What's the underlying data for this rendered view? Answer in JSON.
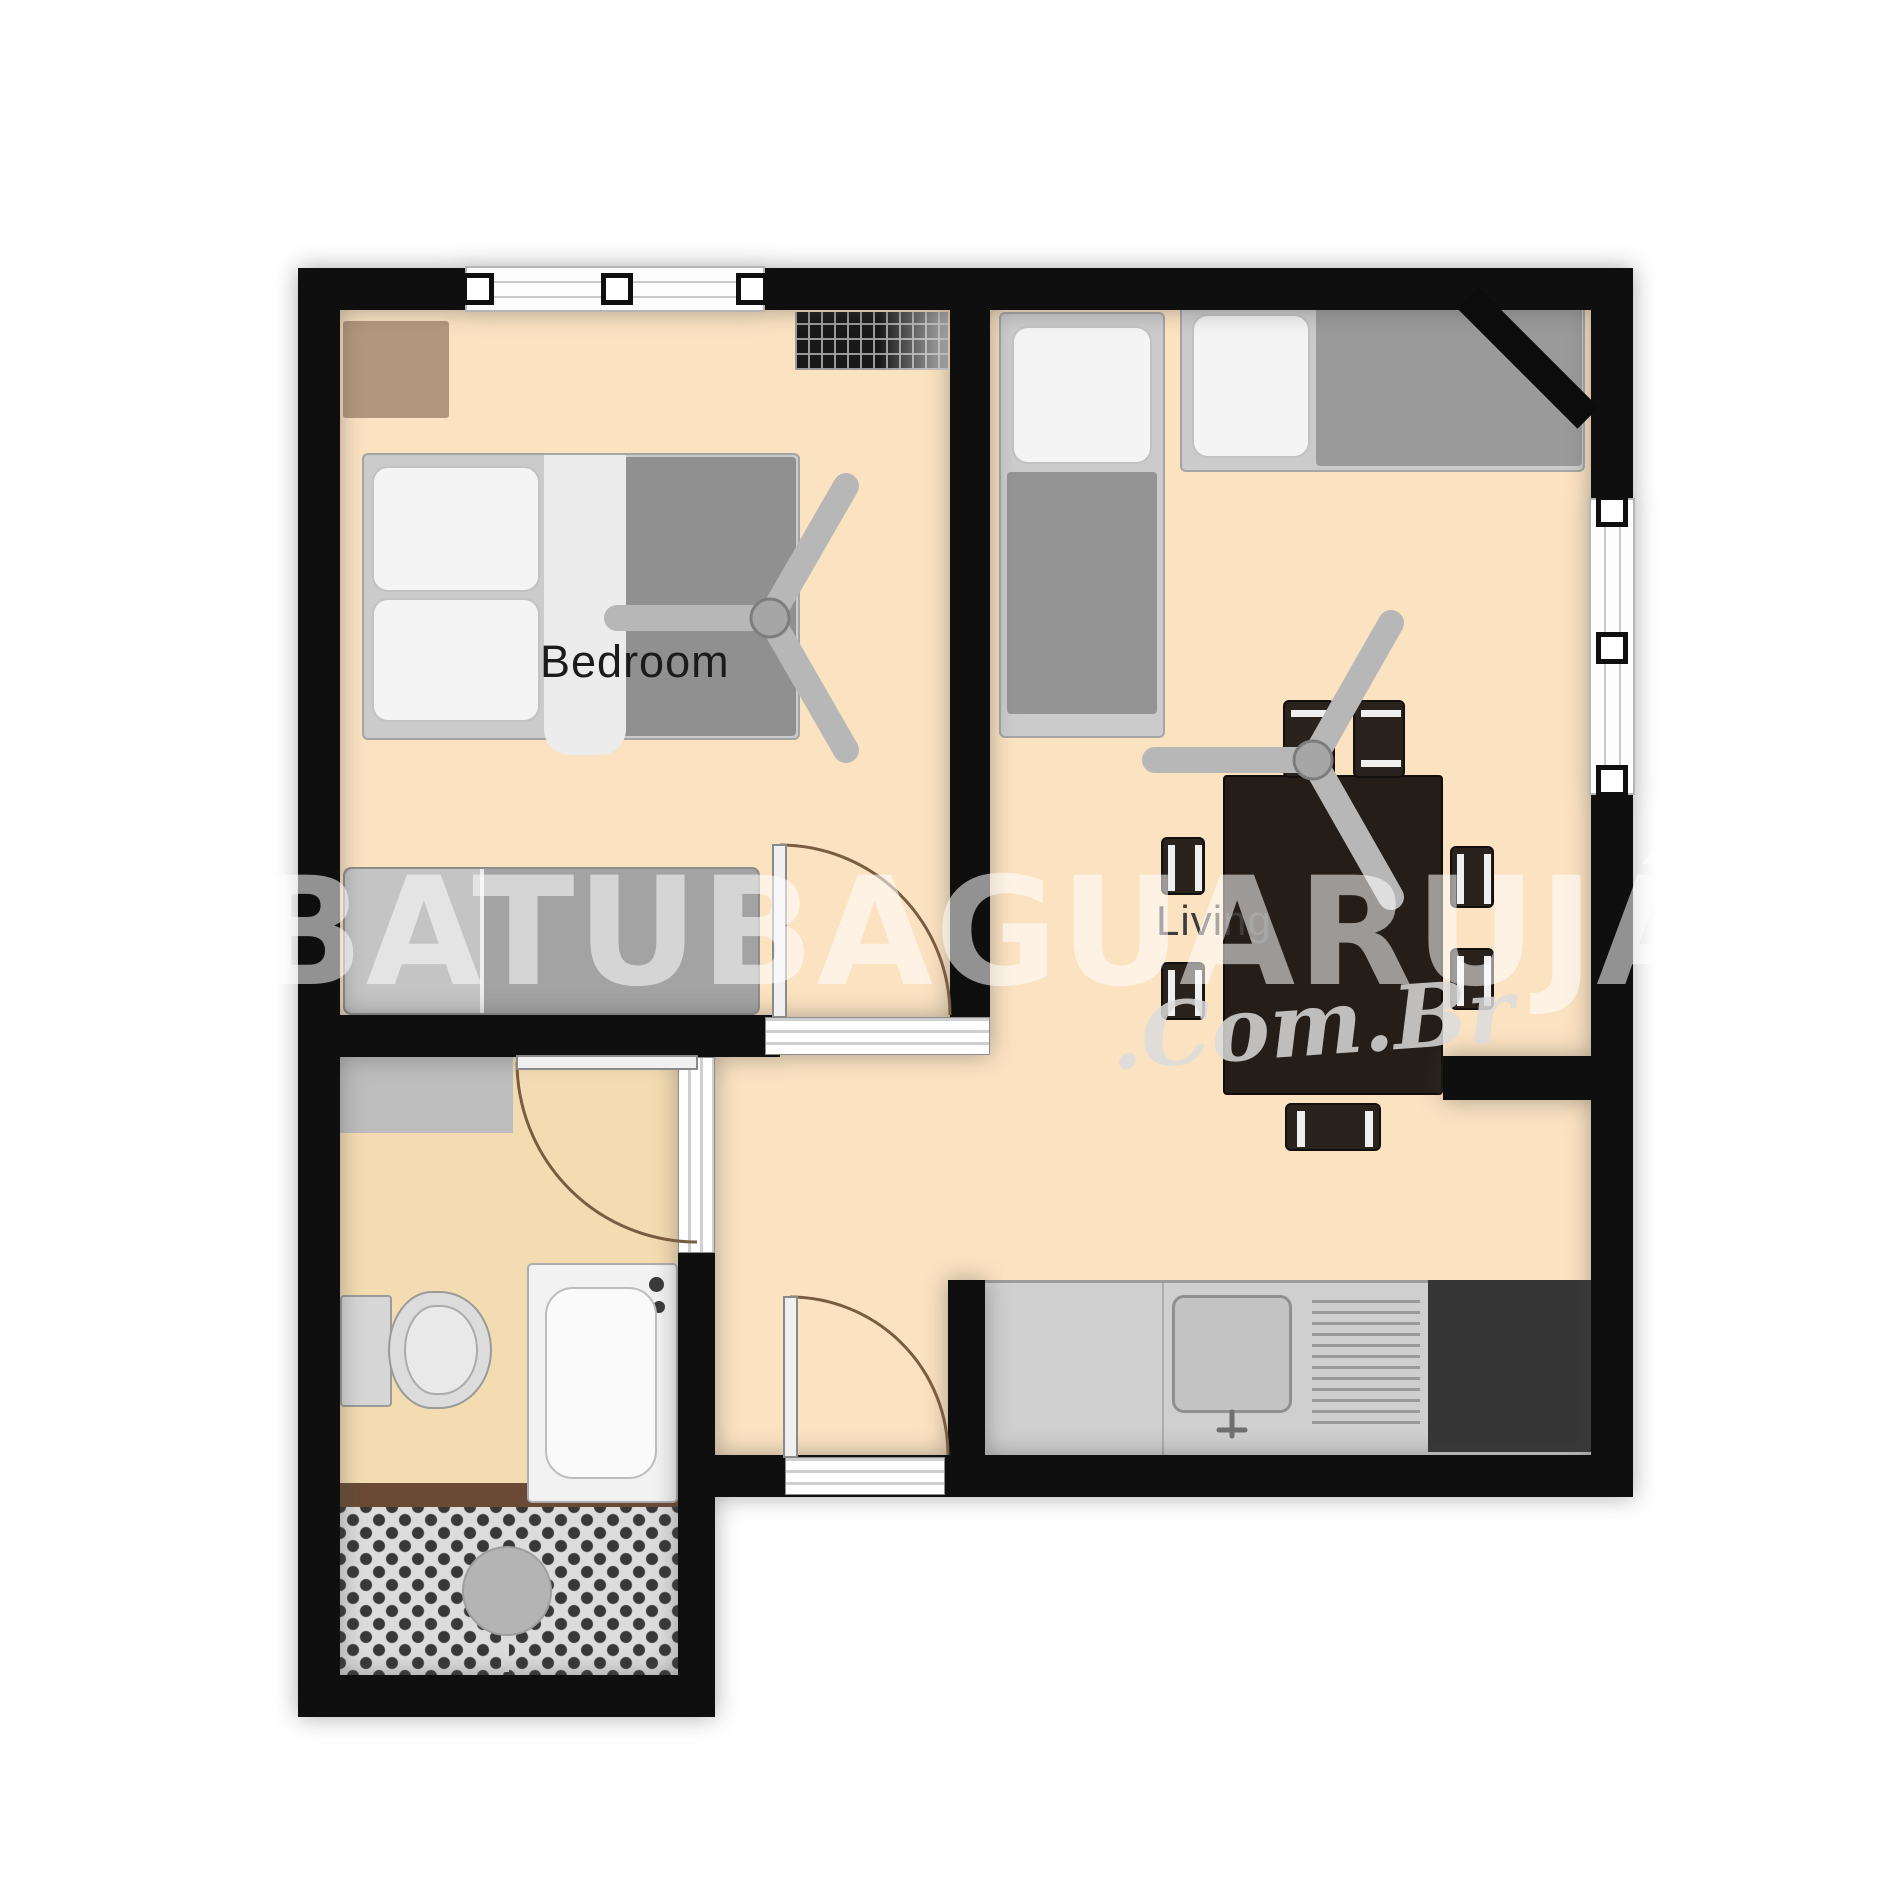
{
  "title": "Apartment floor plan",
  "rooms": {
    "bedroom": {
      "label": "Bedroom"
    },
    "living": {
      "label": "Living"
    },
    "bathroom": {
      "label": ""
    },
    "kitchen": {
      "label": ""
    },
    "balcony": {
      "label": ""
    }
  },
  "watermark": {
    "main": "UBATUBAGUARUJÁ",
    "suffix": ".Com.Br"
  },
  "furniture": [
    "double-bed",
    "sofa-bed",
    "bedroom-ceiling-fan",
    "bedroom-rug",
    "ac-grille",
    "single-bed-vertical",
    "single-bed-horizontal",
    "corner-tv",
    "dining-table",
    "dining-chair x7",
    "living-ceiling-fan",
    "kitchen-counter",
    "kitchen-sink",
    "drainer",
    "stove",
    "shower-mat",
    "toilet",
    "bathtub",
    "balcony-parasol"
  ],
  "palette": {
    "wall": "#0f0f0f",
    "floor": "#fbe2c1",
    "bathroom_floor": "#f4dcb2",
    "furniture_gray": "#9a9a9a",
    "rug_brown": "#b2977c",
    "table_dark": "#251e18",
    "watermark_white": "rgba(255,255,255,0.55)",
    "door_arc": "#7a5c40"
  }
}
